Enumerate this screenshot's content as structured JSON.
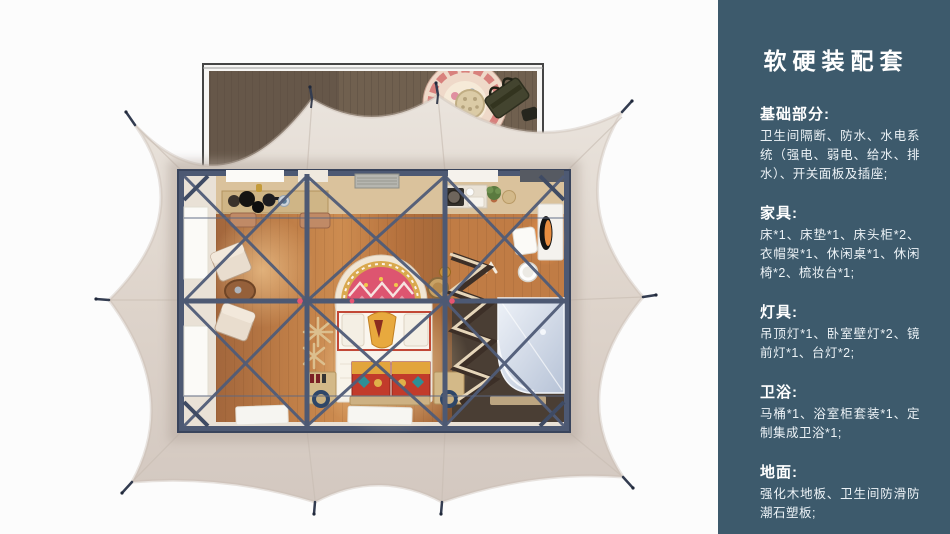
{
  "page": {
    "background": "#fcfcfc"
  },
  "sidebar": {
    "background": "#3d5a6c",
    "title": "软硬装配套",
    "sections": [
      {
        "heading": "基础部分:",
        "body": "卫生间隔断、防水、水电系统（强电、弱电、给水、排水）、开关面板及插座;"
      },
      {
        "heading": "家具:",
        "body": "床*1、床垫*1、床头柜*2、衣帽架*1、休闲桌*1、休闲椅*2、梳妆台*1;"
      },
      {
        "heading": "灯具:",
        "body": "吊顶灯*1、卧室壁灯*2、镜前灯*1、台灯*2;"
      },
      {
        "heading": "卫浴:",
        "body": "马桶*1、浴室柜套装*1、定制集成卫浴*1;"
      },
      {
        "heading": "地面:",
        "body": "强化木地板、卫生间防滑防潮石塑板;"
      }
    ]
  },
  "illustration": {
    "type": "top-view-3d-floorplan-of-glamping-tent",
    "palette": {
      "tent_canvas": "#ded4cb",
      "deck_wood": "#70604f",
      "frame_navy": "#4d5973",
      "floor_wood": "#c07c45",
      "warm_glow": "#ffd9a0",
      "accent_red_tie": "#e65572",
      "bed_rug_red": "#dd5570",
      "shower_glass": "#c5d0e2",
      "bathroom_floor": "#4a3e34"
    }
  }
}
